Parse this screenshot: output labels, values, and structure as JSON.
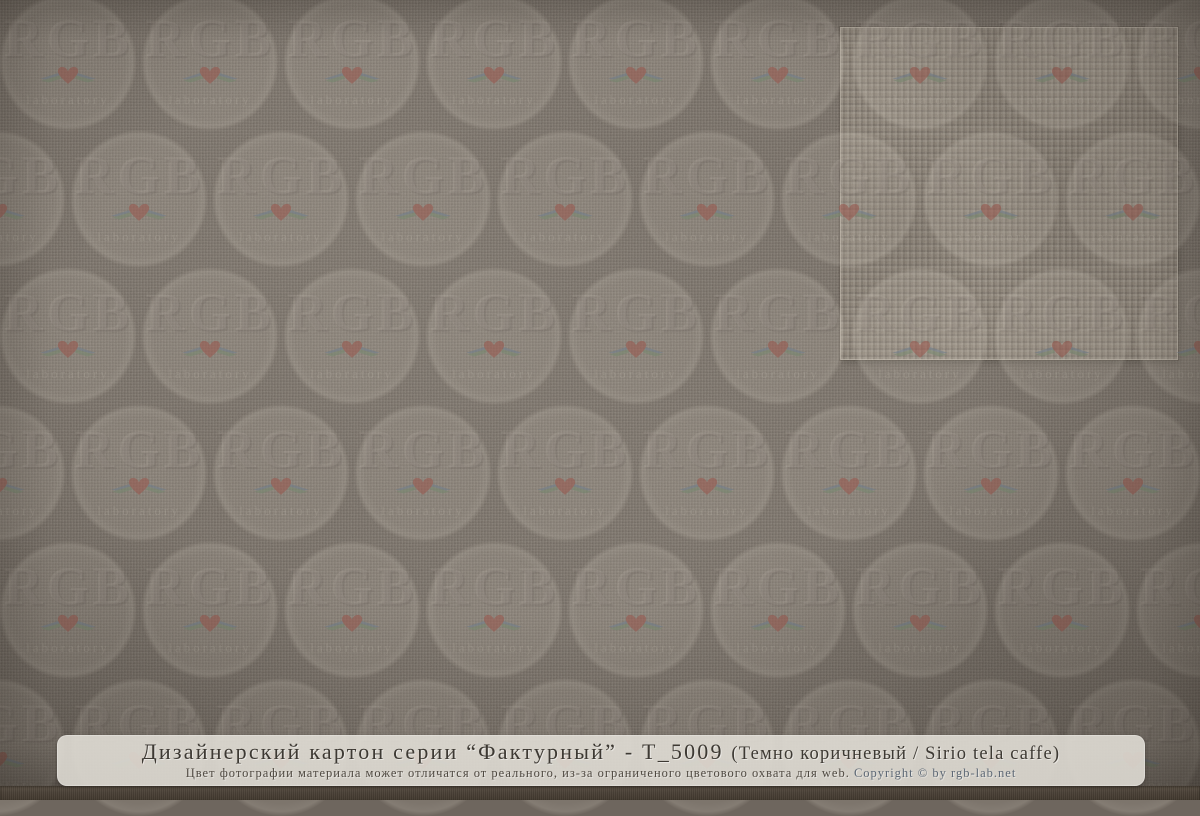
{
  "caption": {
    "title_main": "Дизайнерский картон серии “Фактурный” - Т_5009 ",
    "title_detail": "(Темно коричневый / Sirio tela caffe)",
    "disclaimer": "Цвет фотографии материала может отличатся от реального, из-за ограниченого цветового охвата для web. ",
    "copyright": "Copyright © by rgb-lab.net"
  },
  "watermark": {
    "brand_text": "RGB",
    "sub_text": "laboratory",
    "icon": "heart-with-laurel-wings-icon",
    "grid": {
      "circle_diameter": 138,
      "pitch_x": 142,
      "pitch_y": 137,
      "first_row_center_y": 62,
      "even_row_phase_x": 68,
      "odd_row_offset_x": 71,
      "rows": 6
    },
    "colors": {
      "heart": "#9a564c",
      "wing_blue": "#6f7e8c",
      "wing_green": "#76886f",
      "circle_fill": "#d3cbbe"
    }
  },
  "material": {
    "base_color": "#6e665e",
    "inset_color": "#857c71",
    "bottom_strip_color": "#4a4137"
  }
}
